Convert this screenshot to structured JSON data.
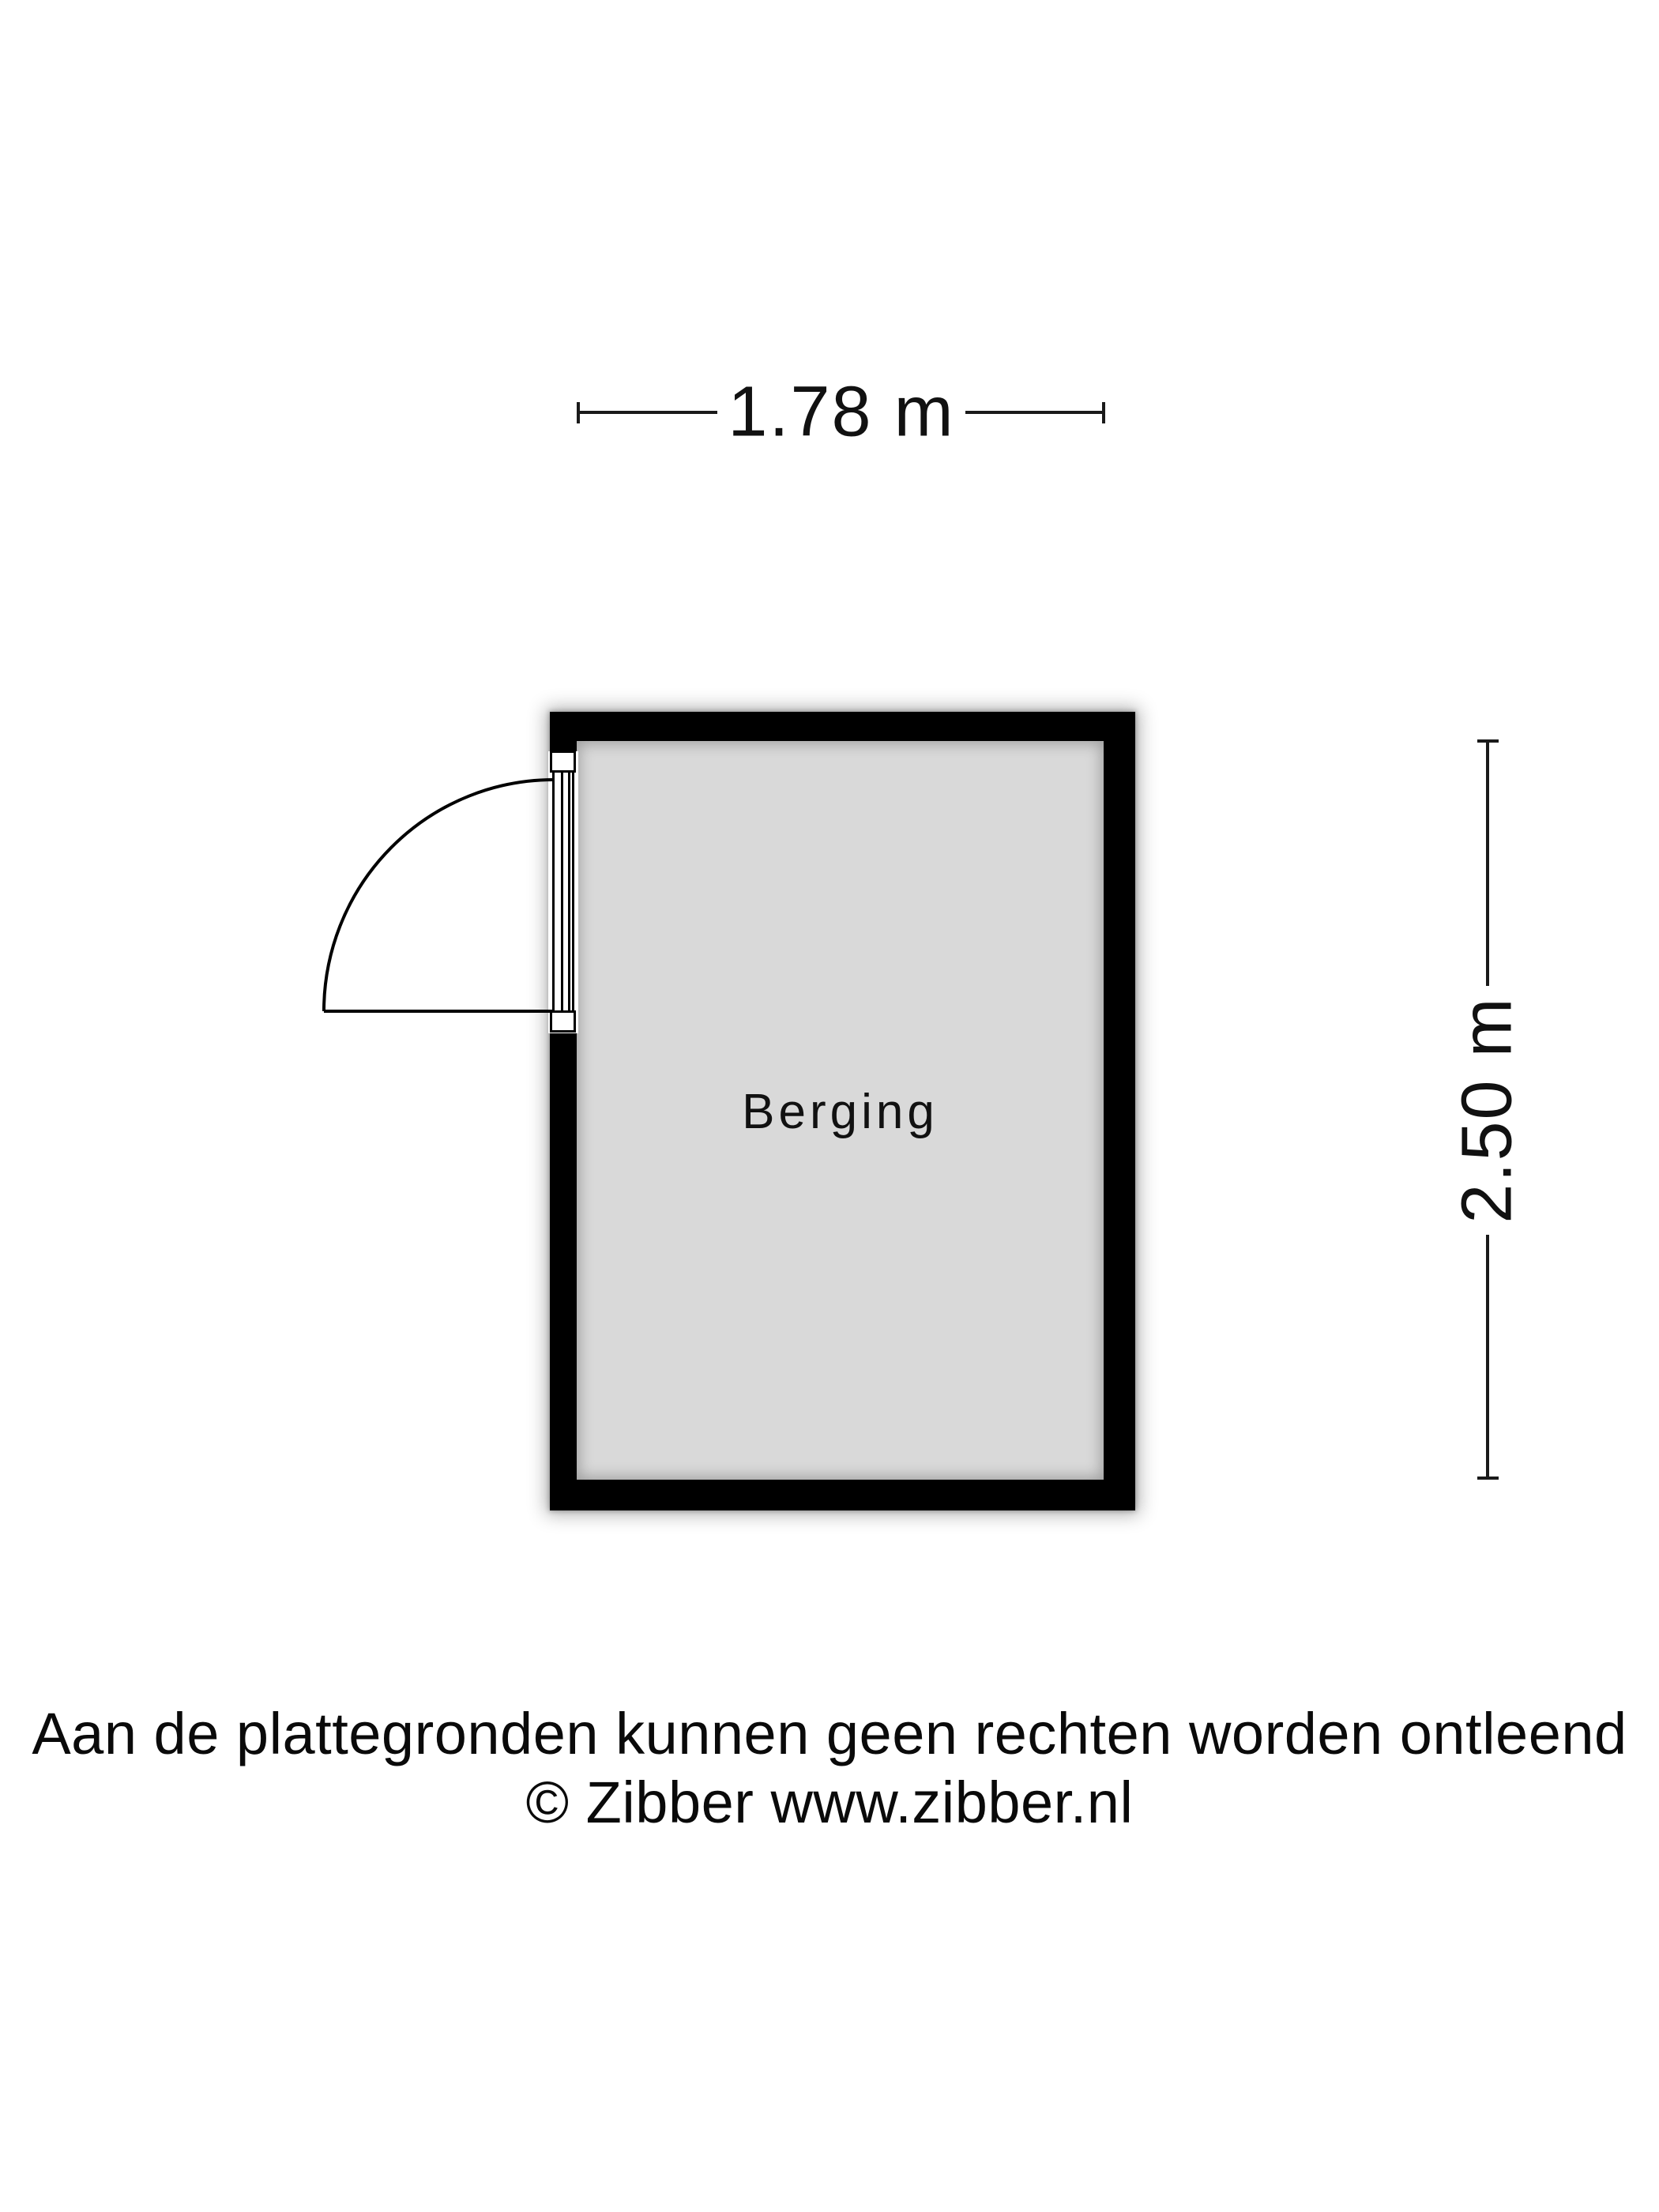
{
  "plan": {
    "room_label": "Berging",
    "dimensions": {
      "width_label": "1.78 m",
      "height_label": "2.50 m"
    },
    "colors": {
      "wall": "#000000",
      "floor": "#d9d9d9",
      "background": "#ffffff",
      "line": "#1a1a1a"
    }
  },
  "footer": {
    "disclaimer": "Aan de plattegronden kunnen geen rechten worden ontleend",
    "copyright": "© Zibber www.zibber.nl"
  }
}
